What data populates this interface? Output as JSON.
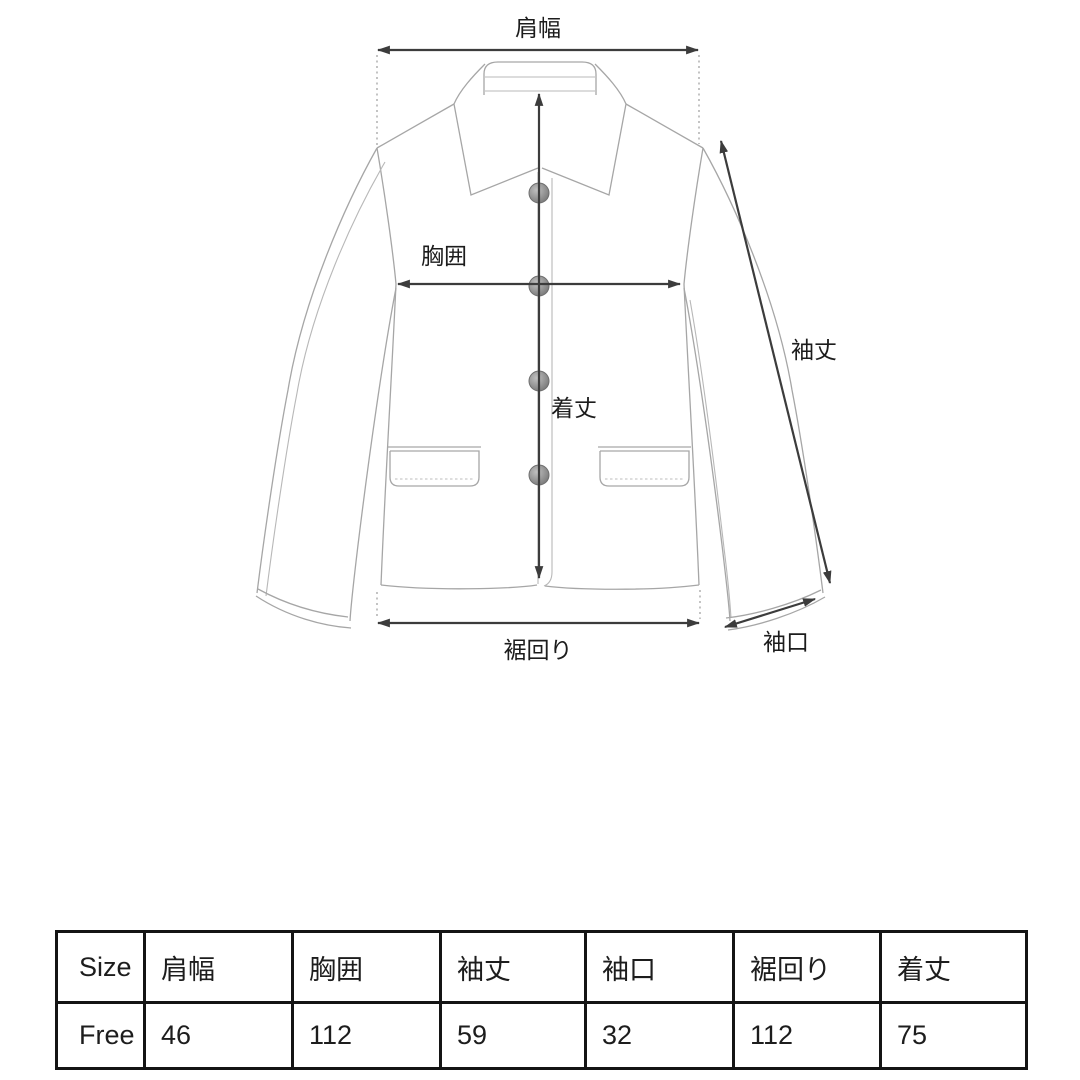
{
  "page": {
    "background": "#ffffff",
    "type": "garment-measurement-guide"
  },
  "diagram": {
    "garment": "jacket",
    "labels": {
      "shoulder_width": "肩幅",
      "chest": "胸囲",
      "body_length": "着丈",
      "sleeve_length": "袖丈",
      "hem_width": "裾回り",
      "cuff": "袖口"
    },
    "colors": {
      "garment_line": "#a6a6a6",
      "arrow": "#3c3c3c",
      "label_text": "#1c1c1c",
      "button_fill": "#8b8b8b"
    },
    "button_count": 4
  },
  "size_table": {
    "columns": [
      "Size",
      "肩幅",
      "胸囲",
      "袖丈",
      "袖口",
      "裾回り",
      "着丈"
    ],
    "rows": [
      [
        "Free",
        "46",
        "112",
        "59",
        "32",
        "112",
        "75"
      ]
    ]
  }
}
